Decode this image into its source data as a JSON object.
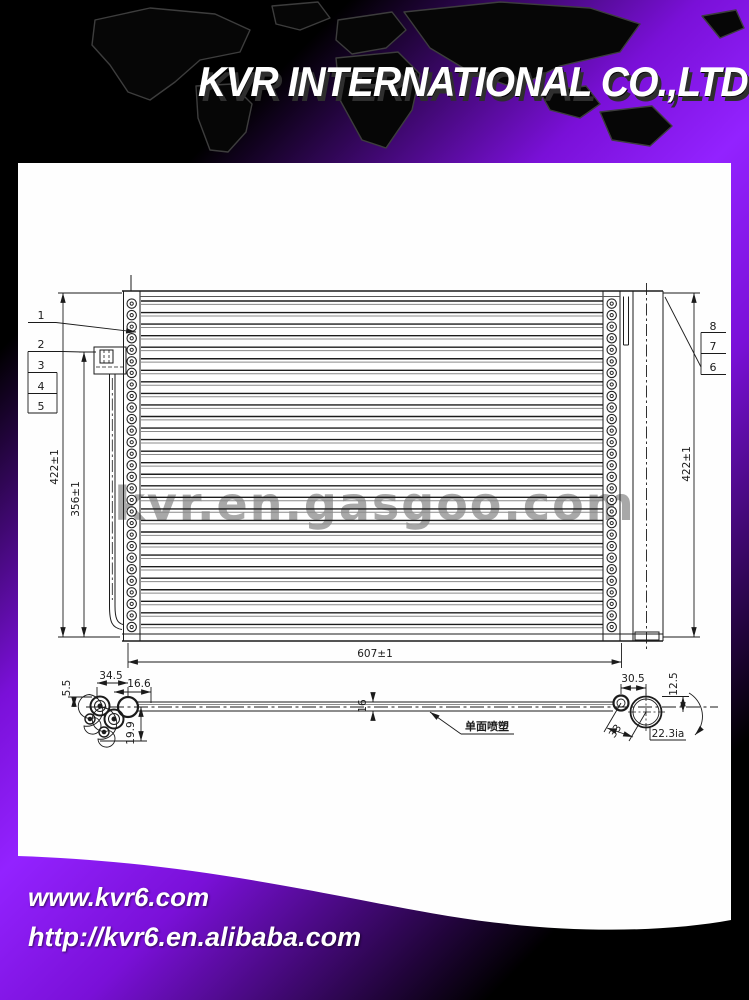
{
  "header": {
    "title": "KVR INTERNATIONAL CO.,LTD",
    "accent_color": "#9322ff"
  },
  "watermark": {
    "text": "kvr.en.gasgoo.com",
    "color": "#9d9d9d"
  },
  "footer": {
    "site_url": "www.kvr6.com",
    "alibaba_url": "http://kvr6.en.alibaba.com"
  },
  "drawing": {
    "callouts": {
      "c1": "1",
      "c2": "2",
      "c3": "3",
      "c4": "4",
      "c5": "5",
      "c6": "6",
      "c7": "7",
      "c8": "8"
    },
    "dimensions": {
      "height_left": "422±1",
      "height_core": "356±1",
      "height_right": "422±1",
      "width": "607±1",
      "port_span": "34.5",
      "port_offset": "5.5",
      "port_inset": "16.6",
      "port_drop": "19.9",
      "bar_thickness": "16",
      "drier_offset": "30.5",
      "drier_drop": "12.5",
      "port_diag": "33",
      "drier_dia": "22.3ia"
    },
    "note_cn": "单面喷塑",
    "core": {
      "tube_count": 29,
      "hole_count": 29
    }
  }
}
